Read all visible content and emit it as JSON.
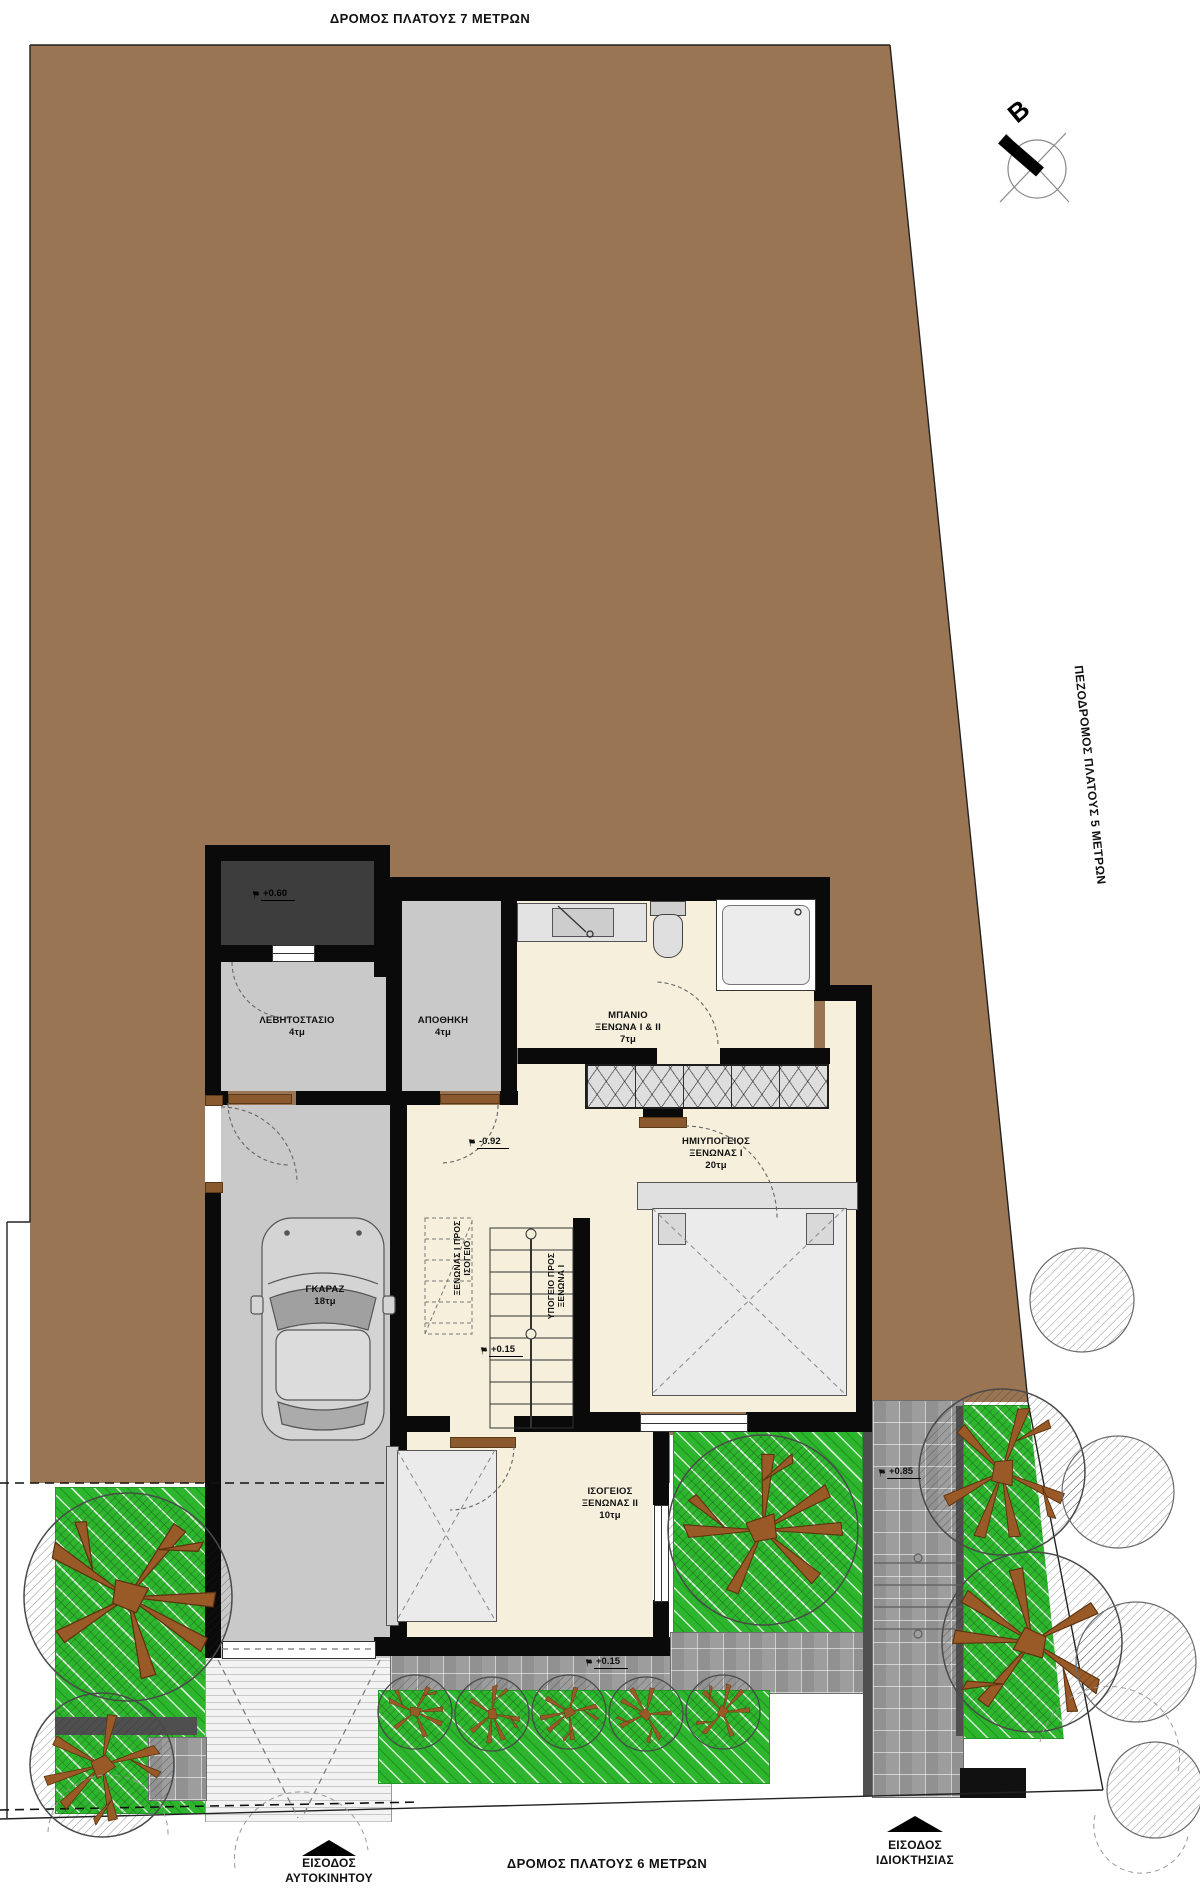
{
  "plan": {
    "roads": {
      "top": "ΔΡΟΜΟΣ ΠΛΑΤΟΥΣ 7 ΜΕΤΡΩΝ",
      "right": "ΠΕΖΟΔΡΟΜΟΣ ΠΛΑΤΟΥΣ 5 ΜΕΤΡΩΝ",
      "bottom": "ΔΡΟΜΟΣ ΠΛΑΤΟΥΣ 6 ΜΕΤΡΩΝ"
    },
    "entrances": {
      "car": {
        "line1": "ΕΙΣΟΔΟΣ",
        "line2": "ΑΥΤΟΚΙΝΗΤΟΥ"
      },
      "property": {
        "line1": "ΕΙΣΟΔΟΣ",
        "line2": "ΙΔΙΟΚΤΗΣΙΑΣ"
      }
    },
    "north_label": "B",
    "rooms": {
      "boiler": {
        "name": "ΛΕΒΗΤΟΣΤΑΣΙΟ",
        "area": "4τμ"
      },
      "storage": {
        "name": "ΑΠΟΘΗΚΗ",
        "area": "4τμ"
      },
      "bath": {
        "line1": "ΜΠΑΝΙΟ",
        "line2": "ΞΕΝΩΝΑ I & II",
        "area": "7τμ"
      },
      "guest1": {
        "line1": "ΗΜΙΥΠΟΓΕΙΟΣ",
        "line2": "ΞΕΝΩΝΑΣ I",
        "area": "20τμ"
      },
      "garage": {
        "name": "ΓΚΑΡΑΖ",
        "area": "18τμ"
      },
      "guest2": {
        "line1": "ΙΣΟΓΕΙΟΣ",
        "line2": "ΞΕΝΩΝΑΣ II",
        "area": "10τμ"
      }
    },
    "stairs": {
      "up": {
        "line1": "ΞΕΝΩΝΑΣ I ΠΡΟΣ",
        "line2": "ΙΣΟΓΕΙΟ"
      },
      "down": {
        "line1": "ΥΠΟΓΕΙΟ ΠΡΟΣ",
        "line2": "ΞΕΝΩΝΑ I"
      }
    },
    "elevations": {
      "porch": "+0.60",
      "hall": "-0.92",
      "stair_landing": "+0.15",
      "terrace": "+0.15",
      "walkway": "+0.85"
    },
    "colors": {
      "site_brown": "#9a7553",
      "grass_green": "#2db52d",
      "floor_cream": "#f5efdc",
      "floor_gray": "#c9c9c9",
      "porch_gray": "#3d3d3d",
      "wall_black": "#0a0a0a",
      "paving_gray": "#9d9d9d",
      "branch_brown": "#9a5a28",
      "door_brown": "#8a5a2e"
    }
  }
}
